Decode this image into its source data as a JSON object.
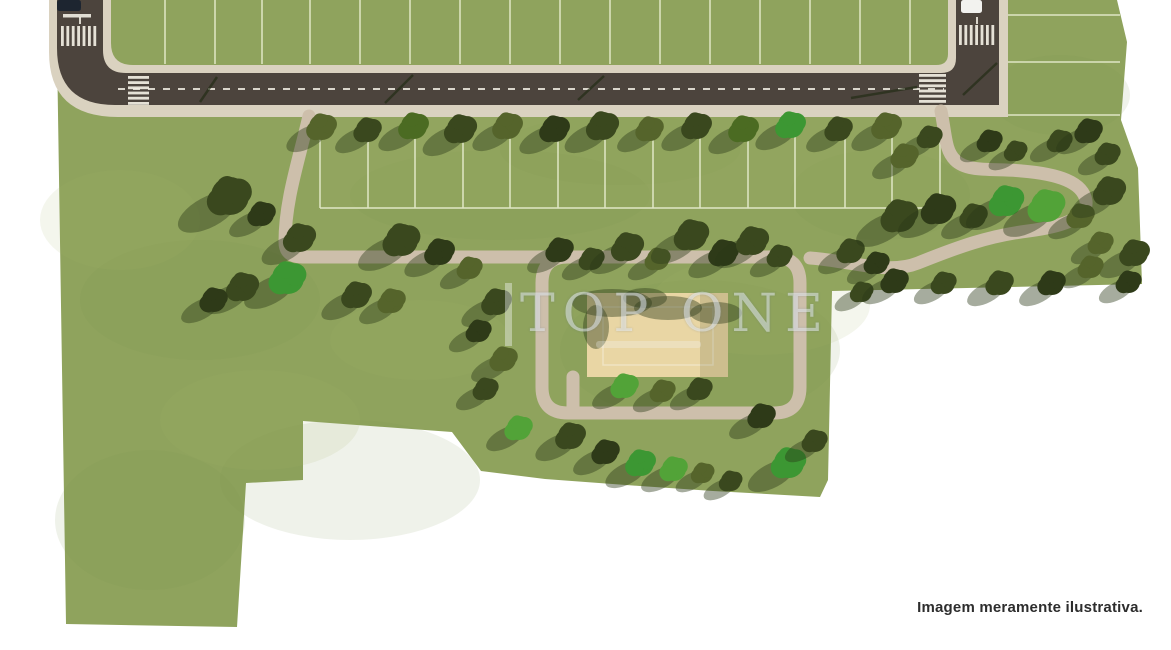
{
  "watermark": {
    "title": "TOP ONE"
  },
  "caption": {
    "text": "Imagem meramente ilustrativa."
  },
  "palette": {
    "page": "#ffffff",
    "grass": "#8fa35d",
    "grass_dark": "#7e924f",
    "grass_light": "#a8b76e",
    "asphalt": "#4c443d",
    "sidewalk": "#dad2c0",
    "path": "#cdbfab",
    "sand": "#e9d6a4",
    "lot_line": "#eef2d8",
    "marking": "#f2efe4",
    "shadow": "#2c3917",
    "tree_dark": "#3a481e",
    "tree_deep": "#2e3a18",
    "tree_olive": "#55642b",
    "tree_medium": "#4b6b22",
    "tree_bright": "#3c9733",
    "tree_bright2": "#52a338",
    "dark_car": "#1d2530",
    "white_car": "#f2f2ef",
    "caption_color": "#2d2d2d"
  },
  "plan": {
    "site": [
      [
        57,
        0
      ],
      [
        1117,
        0
      ],
      [
        1127,
        42
      ],
      [
        1121,
        120
      ],
      [
        1138,
        168
      ],
      [
        1142,
        284
      ],
      [
        832,
        291
      ],
      [
        828,
        480
      ],
      [
        820,
        497
      ],
      [
        713,
        491
      ],
      [
        640,
        486
      ],
      [
        545,
        479
      ],
      [
        481,
        471
      ],
      [
        452,
        432
      ],
      [
        303,
        421
      ],
      [
        303,
        480
      ],
      [
        246,
        483
      ],
      [
        237,
        627
      ],
      [
        66,
        624
      ],
      [
        57,
        50
      ]
    ],
    "mottle": [
      [
        200,
        300,
        120,
        60,
        "d"
      ],
      [
        500,
        195,
        150,
        45,
        "d"
      ],
      [
        700,
        350,
        140,
        70,
        "d"
      ],
      [
        350,
        480,
        130,
        60,
        "d"
      ],
      [
        880,
        195,
        90,
        45,
        "d"
      ],
      [
        150,
        520,
        95,
        70,
        "d"
      ],
      [
        620,
        150,
        120,
        35,
        "d"
      ],
      [
        1060,
        95,
        70,
        40,
        "d"
      ],
      [
        260,
        420,
        100,
        50,
        "l"
      ],
      [
        760,
        305,
        110,
        50,
        "l"
      ],
      [
        420,
        340,
        90,
        40,
        "l"
      ],
      [
        120,
        220,
        80,
        50,
        "l"
      ]
    ],
    "lots": {
      "above_x": [
        165,
        215,
        262,
        310,
        360,
        410,
        460,
        510,
        560,
        610,
        660,
        710,
        760,
        810,
        860,
        910
      ],
      "right_y": [
        15,
        62,
        115
      ],
      "band_x": [
        320,
        368,
        415,
        463,
        510,
        558,
        605,
        653,
        700,
        748,
        795,
        845,
        892,
        940
      ],
      "band_bottom": [
        320,
        208,
        940,
        208
      ],
      "band_overlay": [
        320,
        117,
        620,
        92
      ]
    },
    "road": {
      "sidewalk_d": "M49,0 L111,0 L111,43 Q111,65 133,65 L936,65 Q948,65 948,54 L948,0 L1008,0 L1008,117 L118,117 Q49,117 49,52 Z",
      "asphalt_d": "M57,0 L103,0 L103,50 Q103,73 126,73 L941,73 Q956,73 956,58 L956,0 L999,0 L999,105 L115,105 Q57,105 57,48 Z",
      "dashes": [
        [
          118,
          89,
          944,
          89
        ],
        [
          80,
          2,
          80,
          26
        ],
        [
          977,
          2,
          977,
          26
        ]
      ],
      "stop_line": [
        63,
        14,
        28,
        3.5
      ]
    },
    "crosswalks": [
      {
        "x": 61,
        "y": 26,
        "dir": "v",
        "n": 7,
        "step": 5.4,
        "len": 20
      },
      {
        "x": 959,
        "y": 25,
        "dir": "v",
        "n": 7,
        "step": 5.4,
        "len": 20
      },
      {
        "x": 128,
        "y": 76,
        "dir": "h",
        "n": 6,
        "step": 5.2,
        "len": 21
      },
      {
        "x": 919,
        "y": 74,
        "dir": "h",
        "n": 6,
        "step": 5.2,
        "len": 27
      }
    ],
    "loop_d": "M568,257 L774,257 Q800,257 800,283 L800,387 Q800,413 774,413 L568,413 Q542,413 542,387 L542,283 Q542,257 568,257 Z",
    "paths": [
      "M309,116 C299,160 285,200 285,242 Q285,257 302,257 L560,257",
      "M941,111 C946,136 945,150 955,160 C968,173 995,168 1022,171 C1058,174 1083,182 1086,201 C1088,219 1059,227 1028,231 C988,236 958,247 918,263 C888,275 852,261 810,258",
      "M573,377 L573,410"
    ],
    "sand": {
      "x": 587,
      "y": 293,
      "w": 141,
      "h": 84,
      "inner": [
        603,
        307,
        110,
        58
      ],
      "shade_right": [
        700,
        293,
        28,
        84
      ],
      "shadows": [
        [
          612,
          303,
          40,
          14
        ],
        [
          668,
          308,
          34,
          12
        ],
        [
          716,
          313,
          26,
          11
        ],
        [
          596,
          327,
          13,
          22
        ],
        [
          645,
          298,
          22,
          10
        ]
      ]
    },
    "pole_shadows": [
      [
        200,
        102,
        217,
        77
      ],
      [
        385,
        103,
        413,
        75
      ],
      [
        578,
        100,
        604,
        76
      ],
      [
        851,
        98,
        917,
        87
      ],
      [
        963,
        95,
        997,
        63
      ]
    ],
    "street_trees": [
      [
        322,
        127,
        13,
        "tree_olive"
      ],
      [
        368,
        130,
        12,
        "tree_dark"
      ],
      [
        414,
        126,
        13,
        "tree_medium"
      ],
      [
        461,
        129,
        14,
        "tree_dark"
      ],
      [
        508,
        126,
        13,
        "tree_olive"
      ],
      [
        555,
        129,
        13,
        "tree_deep"
      ],
      [
        603,
        126,
        14,
        "tree_dark"
      ],
      [
        650,
        129,
        12,
        "tree_olive"
      ],
      [
        697,
        126,
        13,
        "tree_dark"
      ],
      [
        744,
        129,
        13,
        "tree_medium"
      ],
      [
        791,
        125,
        13,
        "tree_bright"
      ],
      [
        839,
        129,
        12,
        "tree_dark"
      ],
      [
        887,
        126,
        13,
        "tree_olive"
      ]
    ],
    "trees": [
      [
        230,
        196,
        19,
        "tree_dark"
      ],
      [
        262,
        214,
        12,
        "tree_deep"
      ],
      [
        300,
        238,
        14,
        "tree_dark"
      ],
      [
        288,
        278,
        16,
        "tree_bright"
      ],
      [
        243,
        287,
        14,
        "tree_dark"
      ],
      [
        214,
        300,
        12,
        "tree_deep"
      ],
      [
        402,
        240,
        16,
        "tree_dark"
      ],
      [
        440,
        252,
        13,
        "tree_deep"
      ],
      [
        357,
        295,
        13,
        "tree_dark"
      ],
      [
        392,
        301,
        12,
        "tree_olive"
      ],
      [
        470,
        268,
        11,
        "tree_olive"
      ],
      [
        497,
        302,
        13,
        "tree_dark"
      ],
      [
        479,
        331,
        11,
        "tree_deep"
      ],
      [
        504,
        359,
        12,
        "tree_olive"
      ],
      [
        486,
        389,
        11,
        "tree_dark"
      ],
      [
        519,
        428,
        12,
        "tree_bright2"
      ],
      [
        560,
        250,
        12,
        "tree_deep"
      ],
      [
        592,
        259,
        11,
        "tree_dark"
      ],
      [
        628,
        247,
        14,
        "tree_dark"
      ],
      [
        658,
        259,
        11,
        "tree_olive"
      ],
      [
        692,
        235,
        15,
        "tree_dark"
      ],
      [
        724,
        253,
        13,
        "tree_deep"
      ],
      [
        753,
        241,
        14,
        "tree_dark"
      ],
      [
        780,
        256,
        11,
        "tree_dark"
      ],
      [
        625,
        386,
        12,
        "tree_bright2"
      ],
      [
        663,
        391,
        11,
        "tree_olive"
      ],
      [
        700,
        389,
        11,
        "tree_dark"
      ],
      [
        571,
        436,
        13,
        "tree_dark"
      ],
      [
        606,
        452,
        12,
        "tree_deep"
      ],
      [
        641,
        463,
        13,
        "tree_bright"
      ],
      [
        674,
        469,
        12,
        "tree_bright2"
      ],
      [
        703,
        473,
        10,
        "tree_olive"
      ],
      [
        731,
        481,
        10,
        "tree_dark"
      ],
      [
        762,
        416,
        12,
        "tree_deep"
      ],
      [
        789,
        463,
        15,
        "tree_bright"
      ],
      [
        815,
        441,
        11,
        "tree_dark"
      ],
      [
        851,
        251,
        12,
        "tree_dark"
      ],
      [
        877,
        263,
        11,
        "tree_deep"
      ],
      [
        900,
        216,
        16,
        "tree_dark"
      ],
      [
        939,
        209,
        15,
        "tree_deep"
      ],
      [
        974,
        216,
        12,
        "tree_dark"
      ],
      [
        1007,
        201,
        15,
        "tree_bright"
      ],
      [
        1047,
        206,
        16,
        "tree_bright2"
      ],
      [
        1081,
        216,
        12,
        "tree_olive"
      ],
      [
        1110,
        191,
        14,
        "tree_dark"
      ],
      [
        930,
        137,
        11,
        "tree_dark"
      ],
      [
        990,
        141,
        11,
        "tree_deep"
      ],
      [
        1016,
        151,
        10,
        "tree_dark"
      ],
      [
        1060,
        141,
        11,
        "tree_dark"
      ],
      [
        1089,
        131,
        12,
        "tree_deep"
      ],
      [
        1108,
        154,
        11,
        "tree_dark"
      ],
      [
        905,
        156,
        12,
        "tree_olive"
      ],
      [
        1135,
        253,
        13,
        "tree_dark"
      ],
      [
        1101,
        243,
        11,
        "tree_olive"
      ],
      [
        1129,
        282,
        11,
        "tree_deep"
      ],
      [
        862,
        292,
        10,
        "tree_dark"
      ],
      [
        895,
        281,
        12,
        "tree_deep"
      ],
      [
        944,
        283,
        11,
        "tree_dark"
      ],
      [
        1000,
        283,
        12,
        "tree_dark"
      ],
      [
        1052,
        283,
        12,
        "tree_deep"
      ],
      [
        1091,
        267,
        11,
        "tree_olive"
      ]
    ],
    "cars": [
      [
        57,
        0,
        24,
        11,
        "dark_car"
      ],
      [
        961,
        0,
        21,
        13,
        "white_car"
      ]
    ]
  }
}
